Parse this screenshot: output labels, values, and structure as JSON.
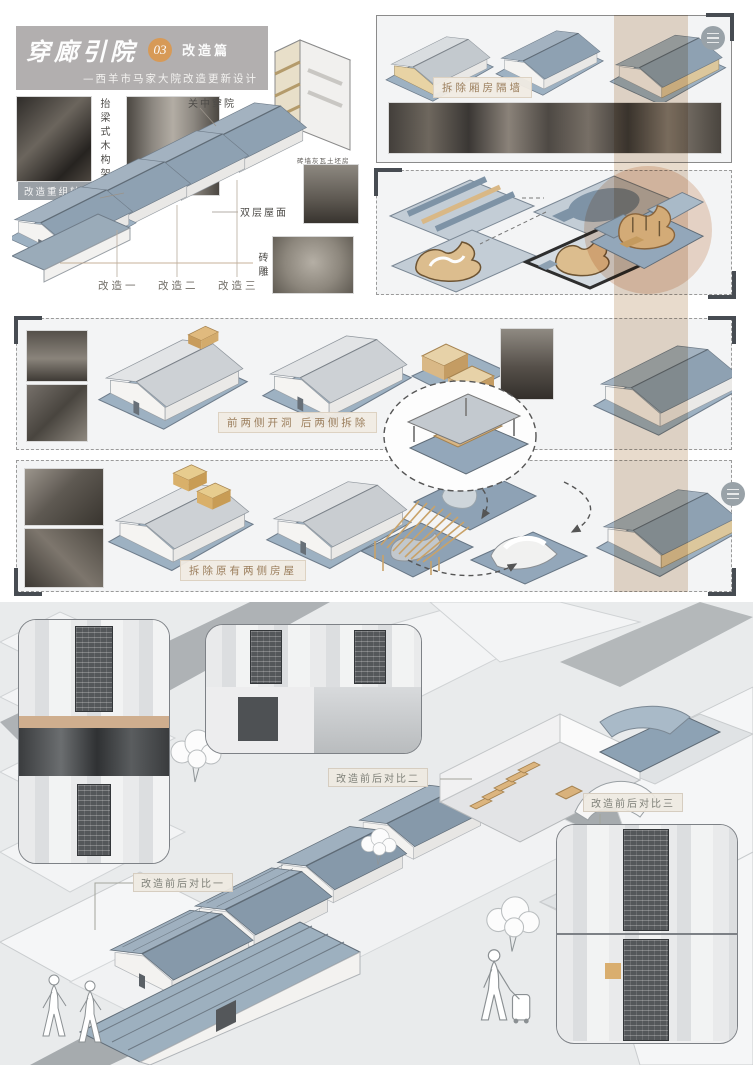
{
  "header": {
    "title": "穿廊引院",
    "number_badge": "03",
    "chapter": "改造篇",
    "subtitle": "—西羊市马家大院改造更新设计"
  },
  "overview": {
    "badge": "改造重组轴侧分析",
    "label_timber_frame": "抬梁式木构架",
    "label_guanzhong_courtyard": "关中穿院",
    "label_double_roof": "双层屋面",
    "label_brick_carving": "砖雕",
    "photo_caption": "砖墙灰瓦土坯房",
    "reno_1": "改造一",
    "reno_2": "改造二",
    "reno_3": "改造三"
  },
  "steps": {
    "demolish_partition": "拆除厢房隔墙",
    "open_front_demolish_back": "前两侧开洞 后两侧拆除",
    "demolish_side_houses": "拆除原有两侧房屋"
  },
  "comparisons": {
    "c1": "改造前后对比一",
    "c2": "改造前后对比二",
    "c3": "改造前后对比三"
  },
  "icons": {
    "panel_handle": "three-line-circle-icon"
  },
  "colors": {
    "accent_orange": "#d79a57",
    "title_bg": "#b2afaf",
    "roof_blue": "#8ba0b2",
    "wood_tan": "#d9b886",
    "band_beige": "#d5bea2",
    "label_brown": "#9b7e5c",
    "site_bg": "#e9ebec"
  }
}
